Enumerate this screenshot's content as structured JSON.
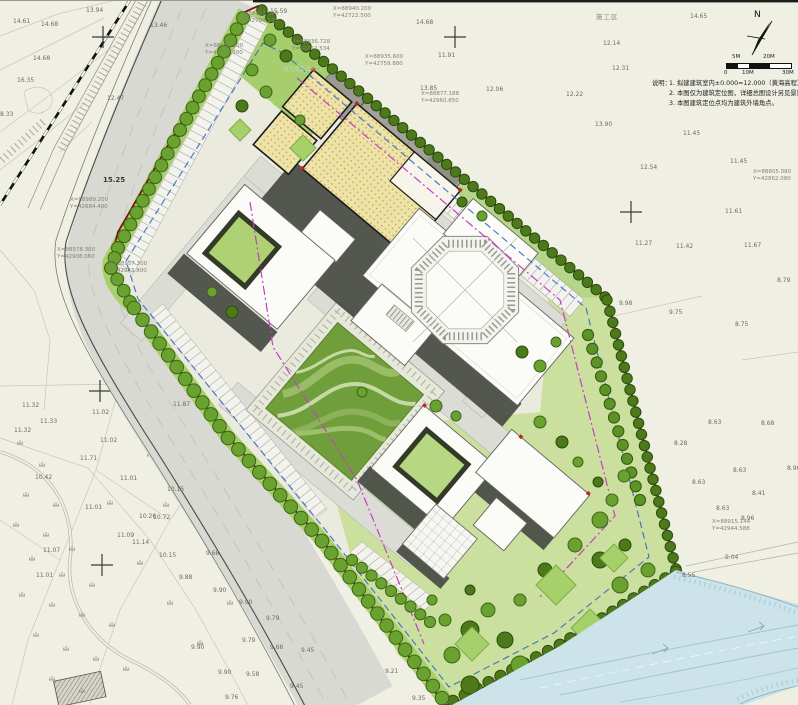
{
  "compass": {
    "label": "N"
  },
  "scale_bar": {
    "top_labels": [
      "5M",
      "20M"
    ],
    "bottom_labels": [
      "0",
      "10M",
      "30M"
    ]
  },
  "notes": {
    "title": "说明：",
    "items": [
      "1. 拟建建筑室内±0.000=12.000（黄海高程）",
      "2. 本图仅为建筑定位图，详细总图设计另见景观设计",
      "3. 本图建筑定位点均为建筑外墙角点。"
    ]
  },
  "area_label": "施工区",
  "garage_label": "地下车库出入口",
  "bold_elevation": {
    "v": "15.25"
  },
  "elevations": [
    {
      "x": 13,
      "y": 19,
      "v": "14.61"
    },
    {
      "x": 86,
      "y": 8,
      "v": "13.94"
    },
    {
      "x": 41,
      "y": 22,
      "v": "14.68"
    },
    {
      "x": 150,
      "y": 23,
      "v": "13.46"
    },
    {
      "x": 33,
      "y": 56,
      "v": "14.68"
    },
    {
      "x": 17,
      "y": 78,
      "v": "16.35"
    },
    {
      "x": 107,
      "y": 96,
      "v": "12.47"
    },
    {
      "x": 0,
      "y": 112,
      "v": "8.33"
    },
    {
      "x": 270,
      "y": 9,
      "v": "15.59"
    },
    {
      "x": 416,
      "y": 20,
      "v": "14.68"
    },
    {
      "x": 438,
      "y": 53,
      "v": "11.91"
    },
    {
      "x": 420,
      "y": 86,
      "v": "13.85"
    },
    {
      "x": 486,
      "y": 87,
      "v": "12.06"
    },
    {
      "x": 690,
      "y": 14,
      "v": "14.65"
    },
    {
      "x": 603,
      "y": 41,
      "v": "12.14"
    },
    {
      "x": 612,
      "y": 66,
      "v": "12.31"
    },
    {
      "x": 566,
      "y": 92,
      "v": "12.22"
    },
    {
      "x": 595,
      "y": 122,
      "v": "13.90"
    },
    {
      "x": 683,
      "y": 131,
      "v": "11.45"
    },
    {
      "x": 640,
      "y": 165,
      "v": "12.54"
    },
    {
      "x": 730,
      "y": 159,
      "v": "11.45"
    },
    {
      "x": 725,
      "y": 209,
      "v": "11.61"
    },
    {
      "x": 635,
      "y": 241,
      "v": "11.27"
    },
    {
      "x": 676,
      "y": 244,
      "v": "11.42"
    },
    {
      "x": 744,
      "y": 243,
      "v": "11.67"
    },
    {
      "x": 777,
      "y": 278,
      "v": "8.79"
    },
    {
      "x": 619,
      "y": 301,
      "v": "9.98"
    },
    {
      "x": 669,
      "y": 310,
      "v": "9.75"
    },
    {
      "x": 735,
      "y": 322,
      "v": "8.75"
    },
    {
      "x": 708,
      "y": 420,
      "v": "8.63"
    },
    {
      "x": 761,
      "y": 421,
      "v": "8.68"
    },
    {
      "x": 674,
      "y": 441,
      "v": "8.28"
    },
    {
      "x": 787,
      "y": 466,
      "v": "8.96"
    },
    {
      "x": 733,
      "y": 468,
      "v": "8.63"
    },
    {
      "x": 692,
      "y": 480,
      "v": "8.63"
    },
    {
      "x": 752,
      "y": 491,
      "v": "8.41"
    },
    {
      "x": 716,
      "y": 506,
      "v": "8.63"
    },
    {
      "x": 741,
      "y": 516,
      "v": "8.96"
    },
    {
      "x": 725,
      "y": 555,
      "v": "9.04"
    },
    {
      "x": 682,
      "y": 573,
      "v": "8.55"
    },
    {
      "x": 22,
      "y": 403,
      "v": "11.32"
    },
    {
      "x": 14,
      "y": 428,
      "v": "11.32"
    },
    {
      "x": 92,
      "y": 410,
      "v": "11.02"
    },
    {
      "x": 40,
      "y": 419,
      "v": "11.33"
    },
    {
      "x": 100,
      "y": 438,
      "v": "11.02"
    },
    {
      "x": 80,
      "y": 456,
      "v": "11.71"
    },
    {
      "x": 120,
      "y": 476,
      "v": "11.01"
    },
    {
      "x": 35,
      "y": 475,
      "v": "10.42"
    },
    {
      "x": 85,
      "y": 505,
      "v": "11.01"
    },
    {
      "x": 167,
      "y": 487,
      "v": "10.15"
    },
    {
      "x": 139,
      "y": 514,
      "v": "10.26"
    },
    {
      "x": 153,
      "y": 515,
      "v": "10.72"
    },
    {
      "x": 117,
      "y": 533,
      "v": "11.09"
    },
    {
      "x": 132,
      "y": 540,
      "v": "11.14"
    },
    {
      "x": 159,
      "y": 553,
      "v": "10.15"
    },
    {
      "x": 43,
      "y": 548,
      "v": "11.07"
    },
    {
      "x": 173,
      "y": 402,
      "v": "11.87"
    },
    {
      "x": 36,
      "y": 573,
      "v": "11.01"
    },
    {
      "x": 206,
      "y": 551,
      "v": "9.68"
    },
    {
      "x": 179,
      "y": 575,
      "v": "9.88"
    },
    {
      "x": 213,
      "y": 588,
      "v": "9.90"
    },
    {
      "x": 239,
      "y": 600,
      "v": "9.90"
    },
    {
      "x": 266,
      "y": 616,
      "v": "9.79"
    },
    {
      "x": 242,
      "y": 638,
      "v": "9.79"
    },
    {
      "x": 191,
      "y": 645,
      "v": "9.90"
    },
    {
      "x": 270,
      "y": 645,
      "v": "9.66"
    },
    {
      "x": 301,
      "y": 648,
      "v": "9.45"
    },
    {
      "x": 218,
      "y": 670,
      "v": "9.90"
    },
    {
      "x": 246,
      "y": 672,
      "v": "9.58"
    },
    {
      "x": 290,
      "y": 684,
      "v": "9.45"
    },
    {
      "x": 225,
      "y": 695,
      "v": "9.76"
    },
    {
      "x": 385,
      "y": 669,
      "v": "9.21"
    },
    {
      "x": 412,
      "y": 696,
      "v": "9.35"
    }
  ],
  "coordinates": [
    {
      "x": 333,
      "y": 6,
      "l1": "X=88940.200",
      "l2": "Y=42722.500"
    },
    {
      "x": 292,
      "y": 39,
      "l1": "X=88936.728",
      "l2": "Y=42752.534"
    },
    {
      "x": 365,
      "y": 54,
      "l1": "X=88935.600",
      "l2": "Y=42759.880"
    },
    {
      "x": 240,
      "y": 11,
      "l1": "X=88951.290",
      "l2": "Y=42704.120"
    },
    {
      "x": 205,
      "y": 43,
      "l1": "X=88950.900",
      "l2": "Y=42734.300"
    },
    {
      "x": 70,
      "y": 197,
      "l1": "X=88989.200",
      "l2": "Y=42684.400"
    },
    {
      "x": 57,
      "y": 247,
      "l1": "X=88978.300",
      "l2": "Y=42908.060"
    },
    {
      "x": 109,
      "y": 261,
      "l1": "X=88957.300",
      "l2": "Y=42943.800"
    },
    {
      "x": 712,
      "y": 519,
      "l1": "X=88915.144",
      "l2": "Y=42944.588"
    },
    {
      "x": 753,
      "y": 169,
      "l1": "X=88805.080",
      "l2": "Y=42862.080"
    },
    {
      "x": 421,
      "y": 91,
      "l1": "X=88877.188",
      "l2": "Y=42960.850"
    }
  ],
  "colors": {
    "boundary_red": "#7d150c",
    "setback_magenta": "#c73bc7",
    "redline_blue": "#3a6bc8",
    "water": "#cde3ea",
    "lawn": "#6f9e3b",
    "tree_dark": "#4c7a1b",
    "tree_dark_edge": "#2c4a0d",
    "tree_light": "#69a22f",
    "tree_light_edge": "#3d641a",
    "building_yellow": "#eee3a6",
    "road_gray": "#d9d9d3",
    "shadow": "#474b44"
  }
}
